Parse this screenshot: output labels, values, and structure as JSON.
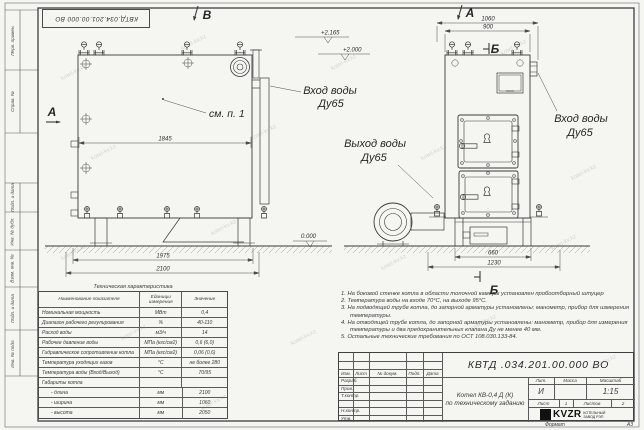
{
  "colors": {
    "paper": "#f5f5f2",
    "line": "#3a3a3a",
    "frame": "#4a4a4a",
    "watermark": "#8c8c8c"
  },
  "watermark": "kotel-kv.kz",
  "stamp_top": "КВТД.034.201.00.000  ВО",
  "frame_fields": [
    "Перв. примен.",
    "Справ. №",
    "Подп. и дата",
    "Инв. № дубл.",
    "Взам. инв. №",
    "Подп. и дата",
    "Инв. № подл."
  ],
  "labels": {
    "view_b": "В",
    "view_a_front": "А",
    "view_a_side": "А",
    "section_b_top": "Б",
    "section_b_bottom": "Б",
    "see_note": "см. п. 1",
    "elev_top": "+2.165",
    "elev_mid": "+2.000",
    "elev_zero": "0.000",
    "inlet_front_1": "Вход воды",
    "inlet_front_2": "Ду65",
    "outlet_1": "Выход воды",
    "outlet_2": "Ду65",
    "inlet_side_1": "Вход воды",
    "inlet_side_2": "Ду65"
  },
  "dims": {
    "front_inner": "1845",
    "front_legs": "1975",
    "front_total": "2100",
    "side_total": "1060",
    "side_top": "900",
    "side_base": "660",
    "side_full": "1230"
  },
  "table": {
    "title": "Техническая характеристика",
    "headers": [
      "Наименование показателя",
      "Единицы измерения",
      "Значение"
    ],
    "rows": [
      [
        "Номинальная мощность",
        "МВт",
        "0,4"
      ],
      [
        "Диапазон рабочего регулирования",
        "%",
        "40-110"
      ],
      [
        "Расход воды",
        "м3/ч",
        "14"
      ],
      [
        "Рабочее давление воды",
        "МПа (кгс/см2)",
        "0,6 (6,0)"
      ],
      [
        "Гидравлическое сопротивление котла",
        "МПа (кгс/см2)",
        "0,06 (0,6)"
      ],
      [
        "Температура уходящих газов",
        "°С",
        "не более 280"
      ],
      [
        "Температура воды (Вход/Выход)",
        "°С",
        "70/95"
      ],
      [
        "Габариты котла",
        "",
        ""
      ],
      [
        "- длина",
        "мм",
        "2100"
      ],
      [
        "- ширина",
        "мм",
        "1060"
      ],
      [
        "- высота",
        "мм",
        "2050"
      ]
    ]
  },
  "notes": [
    "1.  На боковой стенке котла в области топочной камеры установлен пробоотборный штуцер",
    "2.  Температура воды на входе 70°С, на выходе 95°С.",
    "3.  На подводящей трубе котла, до запорной арматуры установлены: манометр, прибор для измерения температуры.",
    "4.  На отводящей трубе котла, до запорной арматуры установлены: манометр, прибор для измерения температуры и два предохранительных клапана Ду не менее 40 мм.",
    "5.  Остальные технические требования по ОСТ 108.030.133-84."
  ],
  "title_block": {
    "doc_number": "КВТД .034.201.00.000  ВО",
    "cols": [
      "Изм.",
      "Лист",
      "№ докум.",
      "Подп.",
      "Дата"
    ],
    "sig_rows": [
      "Разраб.",
      "Пров.",
      "Т.контр.",
      "",
      "Н.контр.",
      "Утв."
    ],
    "product_1": "Котел  КВ-0,4  Д  (К)",
    "product_2": "по техническому заданию",
    "lit": "Лит.",
    "mass": "Масса",
    "scale": "Масштаб",
    "lit_v": "И",
    "scale_v": "1:15",
    "sheet": "Лист",
    "sheet_v": "1",
    "sheets": "Листов",
    "sheets_v": "2",
    "brand": "KVZR",
    "brand_1": "КОТЕЛЬНЫЙ",
    "brand_2": "ЗАВОД РЭП",
    "format_label": "Формат",
    "format_v": "А3"
  }
}
